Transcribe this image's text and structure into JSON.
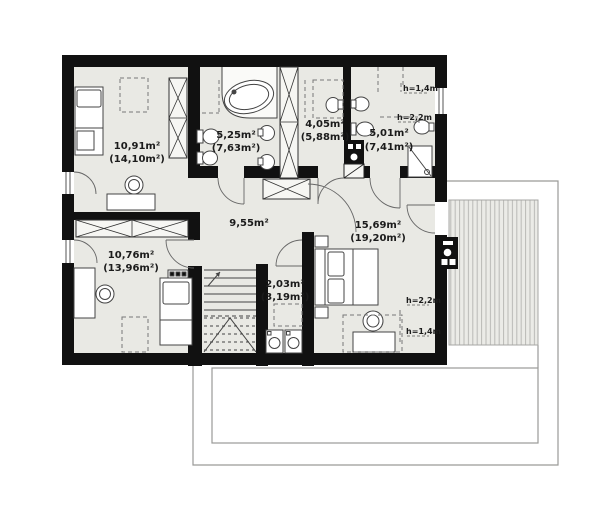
{
  "plan_title": "attic floor plan",
  "colors": {
    "wall": "#111111",
    "floor": "#e9e9e4",
    "outline_gray": "#9a9a98",
    "terrace_bg": "#ebebe7",
    "terrace_stripe": "#b9b9b6",
    "furniture_stroke": "#444444",
    "dash": "#777777",
    "text": "#1b1b1b"
  },
  "rooms": [
    {
      "name": "bedroom-top-left",
      "area": "10,91m²",
      "total": "(14,10m²)"
    },
    {
      "name": "bathroom-main",
      "area": "5,25m²",
      "total": "(7,63m²)"
    },
    {
      "name": "room-top-middle",
      "area": "4,05m²",
      "total": "(5,88m²)"
    },
    {
      "name": "bathroom-top-right",
      "area": "5,01m²",
      "total": "(7,41m²)"
    },
    {
      "name": "hall",
      "area": "9,55m²",
      "total": ""
    },
    {
      "name": "bedroom-bottom-left",
      "area": "10,76m²",
      "total": "(13,96m²)"
    },
    {
      "name": "laundry-closet",
      "area": "2,03m²",
      "total": "(3,19m²)"
    },
    {
      "name": "bedroom-master",
      "area": "15,69m²",
      "total": "(19,20m²)"
    }
  ],
  "height_labels": [
    "h=1,4m",
    "h=2,2m",
    "h=2,2m",
    "h=1,4m"
  ]
}
